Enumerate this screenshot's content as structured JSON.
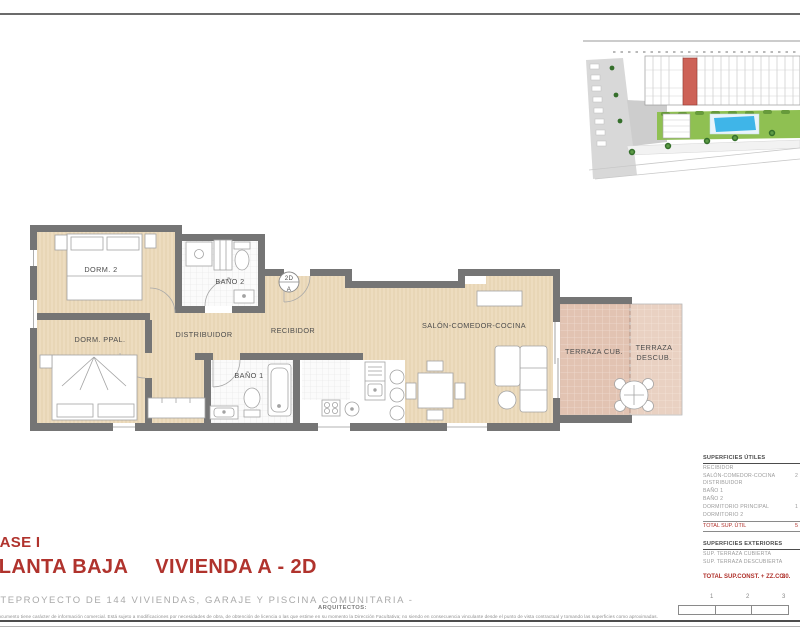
{
  "colors": {
    "accent_red": "#b0332d",
    "wall_gray": "#757575",
    "floor_beige": "#eddcbf",
    "terrace_pink": "#e2c3b2",
    "site_highlight_red": "#cd6257",
    "pool_blue": "#3fb5e8",
    "garden_green": "#8fc052"
  },
  "floorplan": {
    "rooms": {
      "dorm2": "DORM. 2",
      "bano2": "BAÑO 2",
      "dorm_ppal": "DORM. PPAL.",
      "distribuidor": "DISTRIBUIDOR",
      "recibidor": "RECIBIDOR",
      "bano1": "BAÑO 1",
      "salon": "SALÓN-COMEDOR-COCINA",
      "terraza_cub": "TERRAZA CUB.",
      "terraza_descub_1": "TERRAZA",
      "terraza_descub_2": "DESCUB."
    },
    "marker": {
      "top": "2D",
      "bottom": "A"
    }
  },
  "tables": {
    "utiles": {
      "title": "SUPERFICIES ÚTILES",
      "rows": [
        {
          "label": "RECIBIDOR",
          "value": ""
        },
        {
          "label": "SALÓN-COMEDOR-COCINA",
          "value": "2"
        },
        {
          "label": "DISTRIBUIDOR",
          "value": ""
        },
        {
          "label": "BAÑO 1",
          "value": ""
        },
        {
          "label": "BAÑO 2",
          "value": ""
        },
        {
          "label": "DORMITORIO PRINCIPAL",
          "value": "1"
        },
        {
          "label": "DORMITORIO 2",
          "value": ""
        }
      ],
      "total": {
        "label": "TOTAL SUP. ÚTIL",
        "value": "5"
      }
    },
    "exteriores": {
      "title": "SUPERFICIES EXTERIORES",
      "rows": [
        {
          "label": "SUP. TERRAZA CUBIERTA",
          "value": ""
        },
        {
          "label": "SUP. TERRAZA DESCUBIERTA",
          "value": ""
        }
      ]
    },
    "grand_total": {
      "label": "TOTAL SUP.CONST. + ZZ.CC.",
      "value": "80."
    }
  },
  "titleblock": {
    "phase": "FASE I",
    "floor": "PLANTA BAJA",
    "unit": "VIVIENDA A - 2D",
    "project": "ANTEPROYECTO DE 144 VIVIENDAS, GARAJE Y PISCINA COMUNITARIA -",
    "architects_label": "ARQUITECTOS:",
    "disclaimer": "El presente documento tiene carácter de información comercial. Está sujeto a modificaciones por necesidades de obra, de obtención de licencia o las que estime en su momento la Dirección Facultativa; no siendo en consecuencia vinculante desde el punto de vista contractual y tomando las superficies como aproximadas."
  },
  "scale_bar": {
    "labels": [
      "1",
      "2",
      "3"
    ]
  }
}
